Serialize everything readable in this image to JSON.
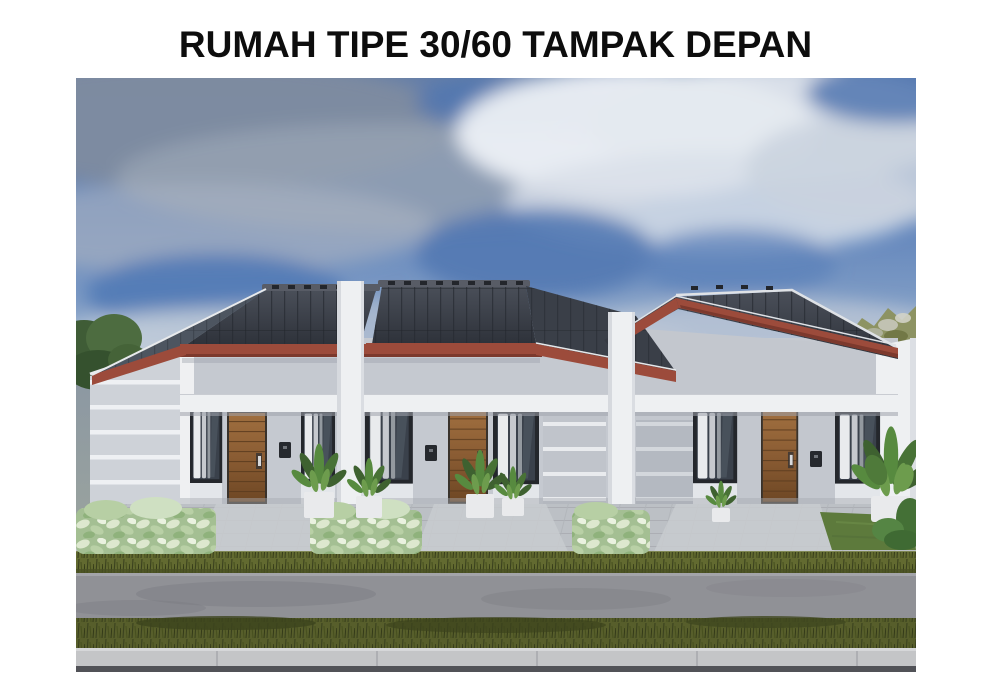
{
  "page": {
    "background": "#ffffff",
    "title": "RUMAH TIPE 30/60 TAMPAK DEPAN"
  },
  "image": {
    "alt": "3D architectural rendering, front view (tampak depan) of a row of three attached type 30/60 houses: dark grey tiled gable roofs with terracotta fascia boards, light grey walls with white accent stripes, white pillars and beams, wooden panel doors, dark framed windows with white curtains, green plants in white planters, variegated shrubs, paved front yard, grass verges, asphalt road and concrete curb under a blue sky with grey and white clouds",
    "houses_count": 3,
    "house_type": "30/60",
    "view": "Tampak Depan",
    "palette": {
      "page_bg": "#ffffff",
      "sky_blue": "#5d82bb",
      "sky_haze": "#b7c3d3",
      "cloud_white": "#edf0f5",
      "cloud_grey": "#95a1b2",
      "roof_dark": "#383c45",
      "roof_side": "#4d5560",
      "roof_line": "#262a31",
      "ridge_cap": "#585c66",
      "fascia_red": "#9c4b3b",
      "fascia_red_dark": "#7c392d",
      "wall_grey": "#c5c9d0",
      "wall_side": "#ced2d8",
      "trim_white": "#eef0f2",
      "stripe_white": "#e9ebee",
      "door_wood": "#8a5c33",
      "door_wood_dark": "#5c3c1e",
      "window_frame": "#24272c",
      "window_glass": "#3a414b",
      "curtain": "#e9ebed",
      "plant_dark": "#3e6130",
      "plant_mid": "#578a3f",
      "plant_light": "#6d9c4d",
      "shrub_base": "#a4bf93",
      "paving": "#bcc0c5",
      "lawn": "#5d7a3c",
      "grass_verge": "#626a30",
      "grass_verge_dark": "#575e2b",
      "road": "#909196",
      "curb": "#c4c5c7",
      "asphalt_dark": "#515257",
      "hill_green": "#8d9363",
      "tree_green": "#3f5c36"
    }
  }
}
